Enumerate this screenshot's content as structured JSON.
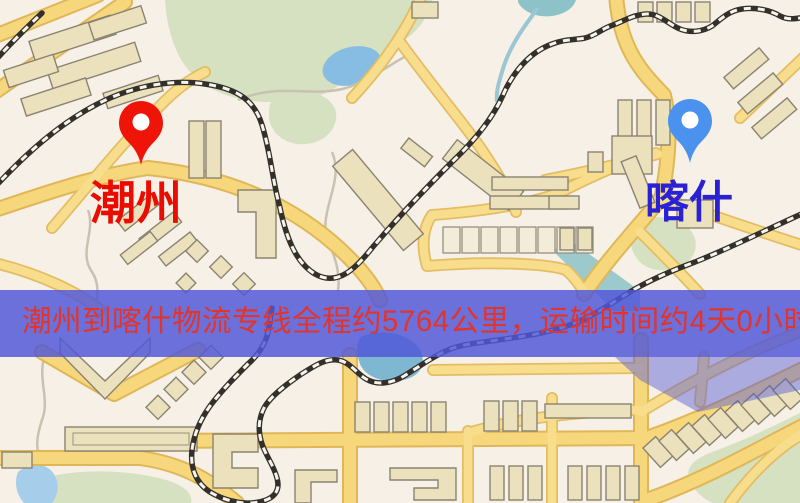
{
  "map": {
    "kind": "street-map-route-overview",
    "origin": {
      "label": "潮州",
      "pin_color": "#ee1408",
      "label_color": "#ea0c00"
    },
    "destination": {
      "label": "喀什",
      "pin_color": "#4b92ef",
      "label_color": "#2a21d4"
    },
    "banner": {
      "text": "潮州到喀什物流专线全程约5764公里，运输时间约4天0小时.",
      "distance_km": "5764",
      "duration": "4天0小时",
      "bg_color": "#5157d8",
      "text_color": "#e2342a"
    },
    "palette": {
      "background": "#f6f0e6",
      "road_fill": "#f7d77b",
      "road_casing": "#e0b758",
      "park": "#d5e1c0",
      "water": "#87bde2",
      "building": "#ebe1bd",
      "railway": "#33302b"
    },
    "icons": {
      "origin_pin": "map-pin-red",
      "destination_pin": "map-pin-blue"
    }
  }
}
